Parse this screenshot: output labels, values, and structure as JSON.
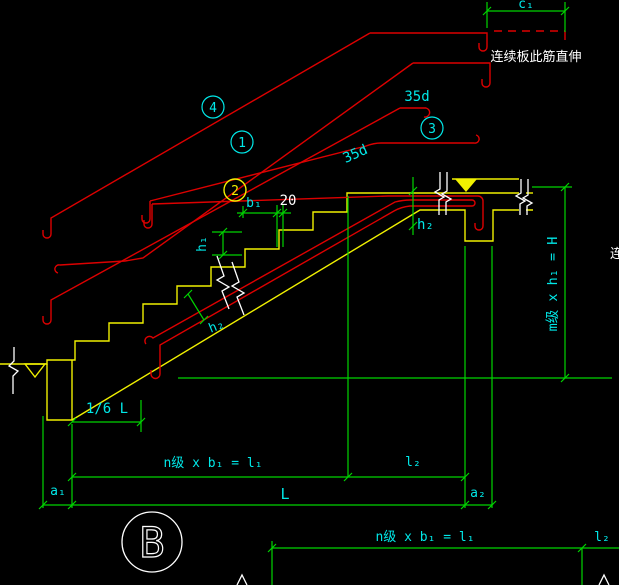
{
  "colors": {
    "background": "#000000",
    "rebar": "#dd0000",
    "outline": "#f0f000",
    "dimension": "#00d400",
    "label": "#00e8e8",
    "annotation": "#ffffff"
  },
  "labels": {
    "c1": "c₁",
    "top_note": "连续板此筋直伸",
    "anchorage_top": "35d",
    "anchorage_mid": "35d",
    "bar_tag_4": "4",
    "bar_tag_1": "1",
    "bar_tag_2": "2",
    "bar_tag_3": "3",
    "tread_width": "b₁",
    "nosing": "20",
    "riser_height": "h₁",
    "landing_thickness": "h₂",
    "slab_thickness": "h₂",
    "total_rise": "m级 x h₁ = H",
    "top_bar_extent": "1/6 L",
    "run_length": "n级 x b₁ = l₁",
    "landing_length": "l₂",
    "left_offset": "a₁",
    "total_length": "L",
    "right_offset": "a₂",
    "detail_mark": "B",
    "run_length_bottom": "n级 x b₁ = l₁",
    "landing_length_bottom": "l₂",
    "right_edge_partial": "连"
  }
}
